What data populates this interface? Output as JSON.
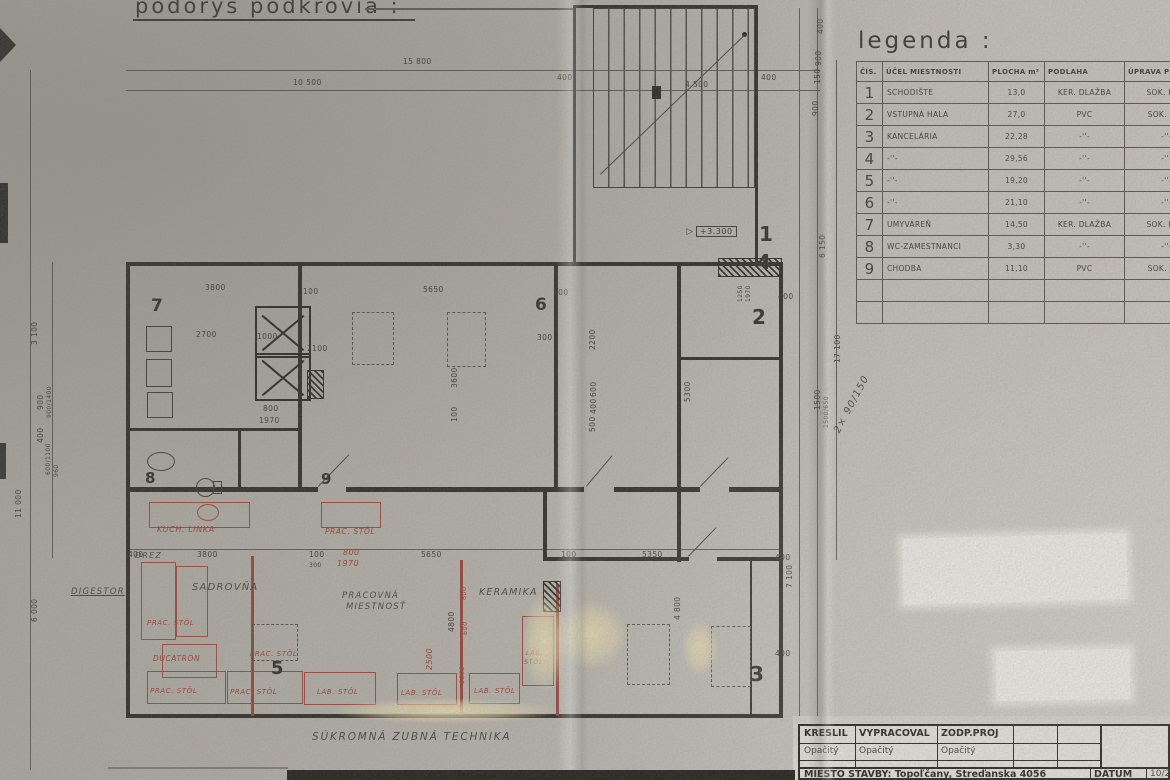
{
  "page": {
    "title": "podorys podkrovia :",
    "bottom_note": "SÚKROMNÁ ZUBNÁ TECHNIKA"
  },
  "legend": {
    "title": "legenda :",
    "headers": [
      "ČÍS.",
      "ÚČEL MIESTNOSTI",
      "PLOCHA m²",
      "PODLAHA",
      "ÚPRAVA POVRCHOV"
    ],
    "rows": [
      {
        "no": "1",
        "purpose": "SCHODIŠTE",
        "area": "13,0",
        "floor": "KER. DLAŽBA",
        "finish": "SOK. KER."
      },
      {
        "no": "2",
        "purpose": "VSTUPNÁ HALA",
        "area": "27,0",
        "floor": "PVC",
        "finish": "SOK. PVC"
      },
      {
        "no": "3",
        "purpose": "KANCELÁRIA",
        "area": "22,28",
        "floor": "-''-",
        "finish": "-''-"
      },
      {
        "no": "4",
        "purpose": "-''-",
        "area": "29,56",
        "floor": "-''-",
        "finish": "-''-"
      },
      {
        "no": "5",
        "purpose": "-''-",
        "area": "19,20",
        "floor": "-''-",
        "finish": "-''-"
      },
      {
        "no": "6",
        "purpose": "-''-",
        "area": "21,10",
        "floor": "-''-",
        "finish": "-''-"
      },
      {
        "no": "7",
        "purpose": "UMYVÁREŇ",
        "area": "14,50",
        "floor": "KER. DLAŽBA",
        "finish": "SOK. KER."
      },
      {
        "no": "8",
        "purpose": "WC-ZAMESTNANCI",
        "area": "3,30",
        "floor": "-''-",
        "finish": "-''-"
      },
      {
        "no": "9",
        "purpose": "CHODBA",
        "area": "11,10",
        "floor": "PVC",
        "finish": "SOK. PVC"
      }
    ]
  },
  "titleblock": {
    "col1_label": "KRESLIL",
    "col2_label": "VYPRACOVAL",
    "col3_label": "ZODP.PROJ",
    "col1_value": "Opačitý",
    "col2_value": "Opačitý",
    "col3_value": "Opačitý",
    "site_label": "MIESTO STAVBY: Topoľčany, Streďanska 4056",
    "date_label": "DÁTUM",
    "date_value": "10/200"
  },
  "plan": {
    "elevation": "+3.300",
    "room_numbers": [
      {
        "t": "7",
        "x": 151,
        "y": 296,
        "fs": 17
      },
      {
        "t": "6",
        "x": 535,
        "y": 295,
        "fs": 17
      },
      {
        "t": "8",
        "x": 145,
        "y": 469,
        "fs": 15
      },
      {
        "t": "9",
        "x": 321,
        "y": 470,
        "fs": 15
      },
      {
        "t": "5",
        "x": 271,
        "y": 658,
        "fs": 18
      },
      {
        "t": "1",
        "x": 759,
        "y": 222,
        "fs": 20
      },
      {
        "t": "4",
        "x": 757,
        "y": 250,
        "fs": 20
      },
      {
        "t": "2",
        "x": 752,
        "y": 305,
        "fs": 20
      },
      {
        "t": "3",
        "x": 750,
        "y": 662,
        "fs": 20
      }
    ],
    "dims": [
      {
        "t": "15 800",
        "x": 403,
        "y": 57
      },
      {
        "t": "10 500",
        "x": 293,
        "y": 78
      },
      {
        "t": "400",
        "x": 557,
        "y": 73
      },
      {
        "t": "4 500",
        "x": 685,
        "y": 80
      },
      {
        "t": "400",
        "x": 761,
        "y": 73
      },
      {
        "t": "400",
        "x": 816,
        "y": 34,
        "r": 1
      },
      {
        "t": "900",
        "x": 814,
        "y": 66,
        "r": 1
      },
      {
        "t": "150",
        "x": 813,
        "y": 84,
        "r": 1
      },
      {
        "t": "900",
        "x": 811,
        "y": 116,
        "r": 1
      },
      {
        "t": "6 150",
        "x": 818,
        "y": 258,
        "r": 1
      },
      {
        "t": "3 100",
        "x": 30,
        "y": 345,
        "r": 1
      },
      {
        "t": "900",
        "x": 36,
        "y": 410,
        "r": 1
      },
      {
        "t": "900/1400",
        "x": 46,
        "y": 418,
        "r": 1,
        "fs": 6
      },
      {
        "t": "400",
        "x": 36,
        "y": 443,
        "r": 1
      },
      {
        "t": "600/1100",
        "x": 45,
        "y": 475,
        "r": 1,
        "fs": 6
      },
      {
        "t": "960",
        "x": 53,
        "y": 477,
        "r": 1,
        "fs": 6
      },
      {
        "t": "11 000",
        "x": 14,
        "y": 518,
        "r": 1
      },
      {
        "t": "6 000",
        "x": 30,
        "y": 622,
        "r": 1
      },
      {
        "t": "3800",
        "x": 205,
        "y": 283
      },
      {
        "t": "100",
        "x": 303,
        "y": 287
      },
      {
        "t": "5650",
        "x": 423,
        "y": 285
      },
      {
        "t": "100",
        "x": 553,
        "y": 288
      },
      {
        "t": "300",
        "x": 537,
        "y": 333
      },
      {
        "t": "2700",
        "x": 196,
        "y": 330
      },
      {
        "t": "1000",
        "x": 257,
        "y": 332
      },
      {
        "t": "2100",
        "x": 307,
        "y": 344
      },
      {
        "t": "800",
        "x": 263,
        "y": 404
      },
      {
        "t": "1970",
        "x": 259,
        "y": 416
      },
      {
        "t": "3600",
        "x": 450,
        "y": 388,
        "r": 1
      },
      {
        "t": "100",
        "x": 450,
        "y": 422,
        "r": 1
      },
      {
        "t": "2200",
        "x": 588,
        "y": 350,
        "r": 1
      },
      {
        "t": "600",
        "x": 589,
        "y": 397,
        "r": 1
      },
      {
        "t": "400",
        "x": 589,
        "y": 414,
        "r": 1
      },
      {
        "t": "500",
        "x": 588,
        "y": 432,
        "r": 1
      },
      {
        "t": "5300",
        "x": 683,
        "y": 402,
        "r": 1
      },
      {
        "t": "7 100",
        "x": 785,
        "y": 588,
        "r": 1
      },
      {
        "t": "4 800",
        "x": 673,
        "y": 620,
        "r": 1
      },
      {
        "t": "17 100",
        "x": 833,
        "y": 363,
        "r": 1
      },
      {
        "t": "1500",
        "x": 813,
        "y": 410,
        "r": 1
      },
      {
        "t": "1500/650",
        "x": 823,
        "y": 428,
        "r": 1,
        "fs": 6
      },
      {
        "t": "1250",
        "x": 737,
        "y": 302,
        "r": 1,
        "fs": 6
      },
      {
        "t": "1970",
        "x": 745,
        "y": 302,
        "r": 1,
        "fs": 6
      },
      {
        "t": "400",
        "x": 778,
        "y": 292
      },
      {
        "t": "400",
        "x": 128,
        "y": 550
      },
      {
        "t": "3800",
        "x": 197,
        "y": 550
      },
      {
        "t": "100",
        "x": 309,
        "y": 550
      },
      {
        "t": "300",
        "x": 309,
        "y": 562,
        "fs": 6
      },
      {
        "t": "5650",
        "x": 421,
        "y": 550
      },
      {
        "t": "100",
        "x": 561,
        "y": 550
      },
      {
        "t": "5350",
        "x": 642,
        "y": 550
      },
      {
        "t": "400",
        "x": 775,
        "y": 553
      },
      {
        "t": "400",
        "x": 775,
        "y": 649
      },
      {
        "t": "4800",
        "x": 447,
        "y": 632,
        "r": 1
      },
      {
        "t": "800",
        "x": 343,
        "y": 548,
        "c": 1,
        "fs": 8
      },
      {
        "t": "1970",
        "x": 337,
        "y": 559,
        "c": 1,
        "fs": 8
      },
      {
        "t": "2500",
        "x": 425,
        "y": 670,
        "r": 1,
        "c": 1,
        "fs": 8
      },
      {
        "t": "600",
        "x": 460,
        "y": 600,
        "r": 1,
        "c": 1,
        "fs": 6.5
      },
      {
        "t": "600",
        "x": 461,
        "y": 635,
        "r": 1,
        "c": 1,
        "fs": 6.5
      },
      {
        "t": "1600",
        "x": 458,
        "y": 684,
        "r": 1,
        "c": 1,
        "fs": 6.5
      }
    ],
    "pencil_labels": [
      {
        "t": "DIGESTOR",
        "x": 71,
        "y": 587,
        "fs": 8.5,
        "u": 1
      },
      {
        "t": "SADROVŇA",
        "x": 192,
        "y": 582,
        "fs": 10
      },
      {
        "t": "PRACOVNÁ",
        "x": 342,
        "y": 591,
        "fs": 8.5
      },
      {
        "t": "MIESTNOSŤ",
        "x": 346,
        "y": 602,
        "fs": 8.5
      },
      {
        "t": "KERAMIKA",
        "x": 479,
        "y": 587,
        "fs": 9.5
      },
      {
        "t": "DREZ",
        "x": 135,
        "y": 551,
        "fs": 8
      },
      {
        "t": "2× 90/150",
        "x": 832,
        "y": 430,
        "fs": 10,
        "rot2": 1
      }
    ],
    "red_labels": [
      {
        "t": "KUCH. LINKA",
        "x": 157,
        "y": 525,
        "fs": 8
      },
      {
        "t": "PRAC. STÔL",
        "x": 325,
        "y": 527,
        "fs": 7.5
      },
      {
        "t": "PRAC. STÔL",
        "x": 147,
        "y": 619,
        "fs": 7
      },
      {
        "t": "DUCATRON",
        "x": 153,
        "y": 654,
        "fs": 7.5
      },
      {
        "t": "PRAC. STÔL",
        "x": 150,
        "y": 687,
        "fs": 7
      },
      {
        "t": "PRAC. STÔL",
        "x": 250,
        "y": 650,
        "fs": 7
      },
      {
        "t": "PRAC. STÔL",
        "x": 230,
        "y": 688,
        "fs": 7
      },
      {
        "t": "LAB. STÔL",
        "x": 317,
        "y": 688,
        "fs": 7
      },
      {
        "t": "LAB. STÔL",
        "x": 401,
        "y": 689,
        "fs": 7
      },
      {
        "t": "LAB. STÔL",
        "x": 474,
        "y": 687,
        "fs": 7
      },
      {
        "t": "LAB.",
        "x": 526,
        "y": 649,
        "fs": 6.5
      },
      {
        "t": "STÔL",
        "x": 524,
        "y": 658,
        "fs": 6.5
      }
    ]
  }
}
